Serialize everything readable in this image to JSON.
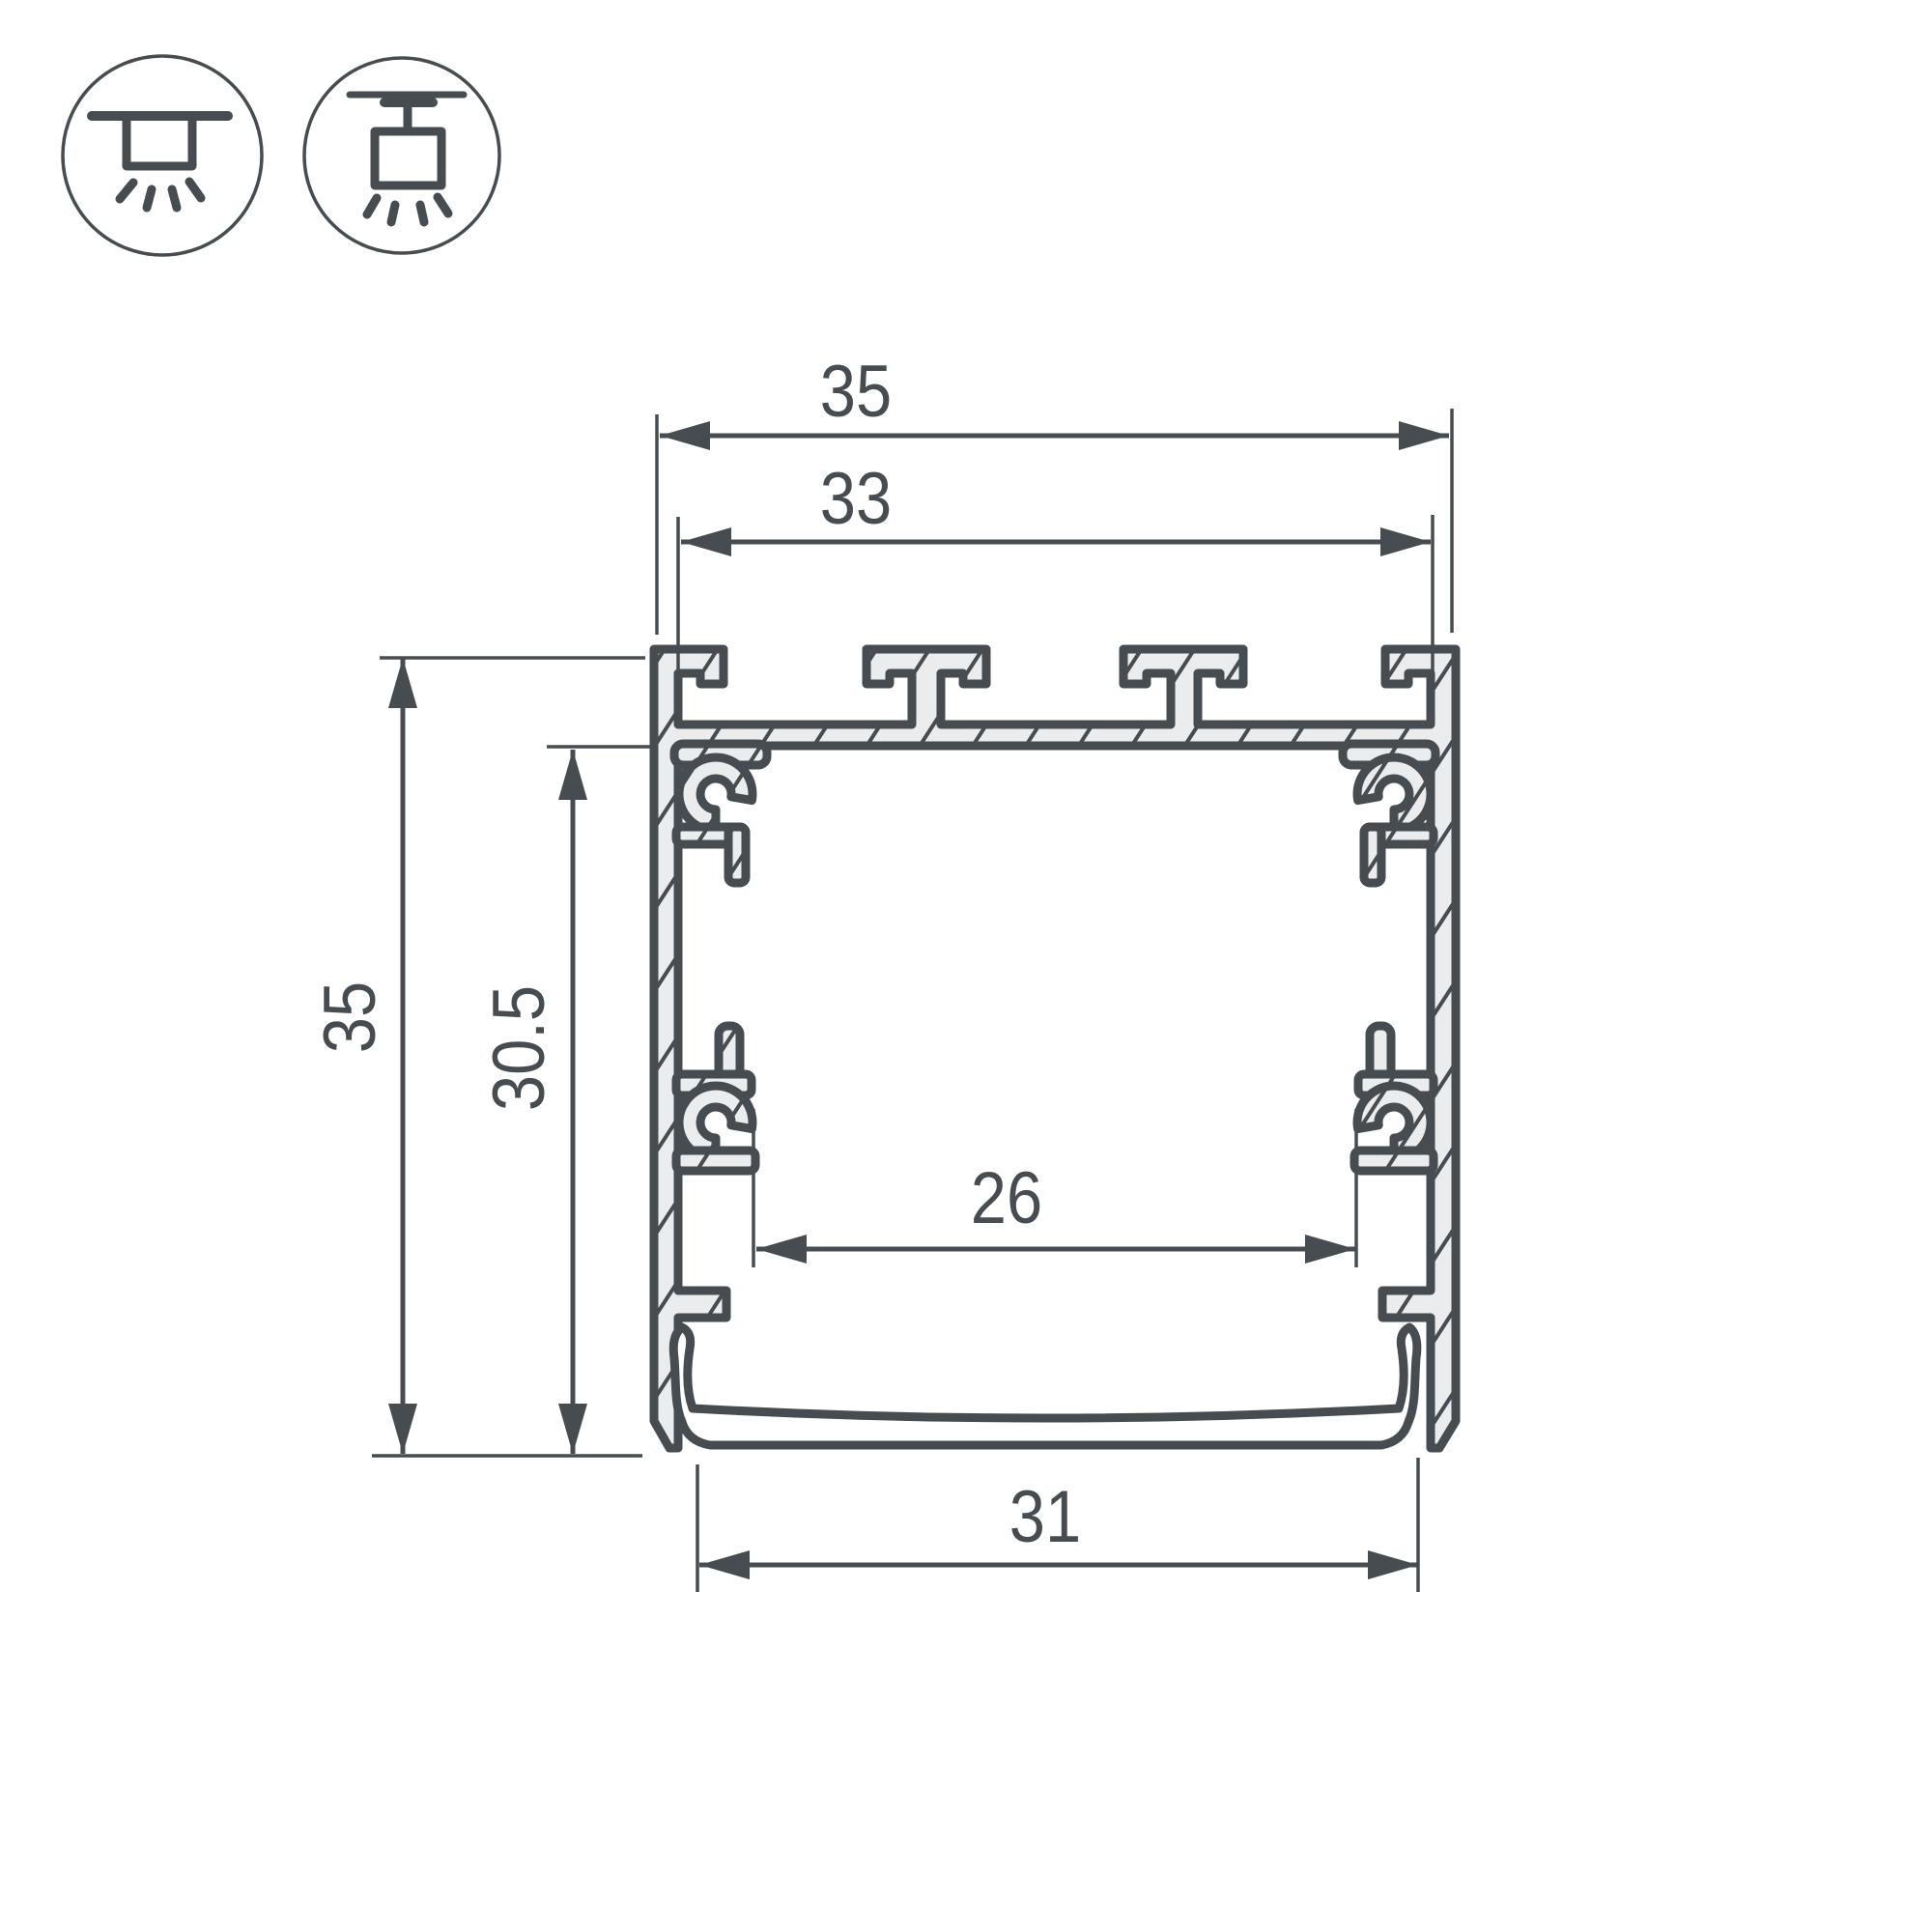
{
  "drawing": {
    "title": "led-profile-cross-section-drawing",
    "dimensions": {
      "outer_width": "35",
      "top_inner_width": "33",
      "outer_height": "35",
      "inner_height": "30.5",
      "inner_channel_width": "26",
      "bottom_width": "31"
    },
    "mount_icons": [
      {
        "name": "surface-ceiling-mount"
      },
      {
        "name": "suspended-pendant-mount"
      }
    ],
    "colors": {
      "ink": "#474c50",
      "aluminium_fill": "#ebeced",
      "background": "#ffffff"
    }
  }
}
